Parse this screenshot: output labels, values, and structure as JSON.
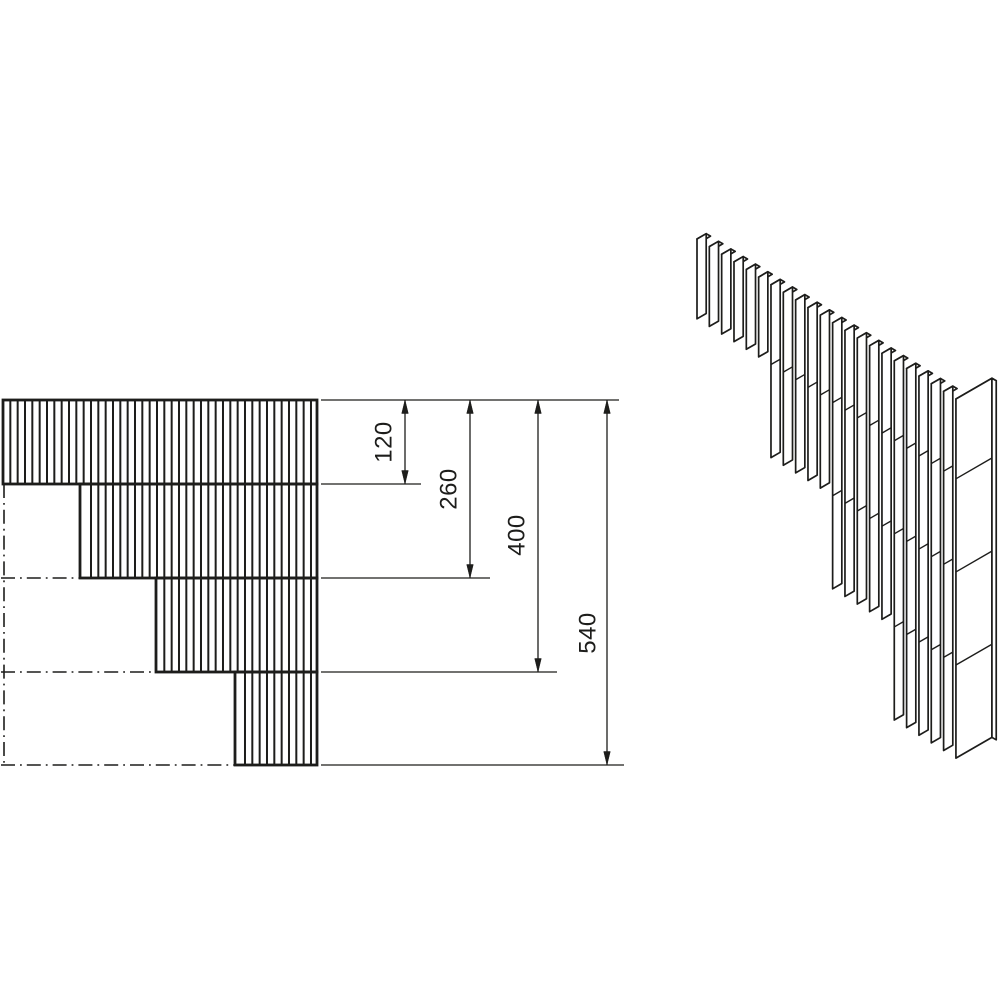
{
  "figure": {
    "background": "#ffffff",
    "ink": "#1d1d1b"
  },
  "front_view": {
    "right": 317,
    "top": 400,
    "row_bottoms": [
      484,
      578,
      672,
      765
    ],
    "row_lefts": [
      3,
      80,
      156,
      235
    ],
    "fin_pitch": 7.333,
    "grid_origin": 3,
    "fin_stroke": 2,
    "border_stroke": 2.8
  },
  "centerlines": {
    "stroke": 1.6,
    "dash": "14 5 1.8 5",
    "vertical": {
      "x": 4,
      "y1": 484,
      "y2": 766
    },
    "horizontal": [
      {
        "y": 578,
        "x1": 1,
        "x2": 80
      },
      {
        "y": 672,
        "x1": 1,
        "x2": 156
      },
      {
        "y": 765,
        "x1": 1,
        "x2": 235
      }
    ]
  },
  "dimensions": {
    "stroke": 1.3,
    "font_size": 24,
    "arrow_half_width": 3.3,
    "arrow_length": 13.5,
    "extension_lines": [
      {
        "y": 400,
        "x1": 321,
        "x2": 619
      },
      {
        "y": 484,
        "x1": 321,
        "x2": 421
      },
      {
        "y": 578,
        "x1": 321,
        "x2": 490
      },
      {
        "y": 672,
        "x1": 321,
        "x2": 557
      },
      {
        "y": 765,
        "x1": 321,
        "x2": 624
      }
    ],
    "lines": [
      {
        "label": "120",
        "x": 405,
        "y1": 400,
        "y2": 484,
        "lx": 384,
        "ly": 442
      },
      {
        "label": "260",
        "x": 470,
        "y1": 400,
        "y2": 578,
        "lx": 449,
        "ly": 489
      },
      {
        "label": "400",
        "x": 538,
        "y1": 400,
        "y2": 672,
        "lx": 517,
        "ly": 535
      },
      {
        "label": "540",
        "x": 607,
        "y1": 400,
        "y2": 765,
        "lx": 588,
        "ly": 633
      }
    ]
  },
  "iso_view": {
    "origin": [
      697,
      239
    ],
    "pitch": [
      12.33,
      7.62
    ],
    "slat_depth": [
      9.2,
      -5.31
    ],
    "end_depth": [
      36,
      -20.78
    ],
    "thickness": [
      4.3,
      2.48
    ],
    "groups": [
      6,
      5,
      5,
      5
    ],
    "module_levels": [
      120,
      260,
      400,
      540
    ],
    "scale": 0.665,
    "stroke": 1.7,
    "joint_stroke": 1.4
  }
}
